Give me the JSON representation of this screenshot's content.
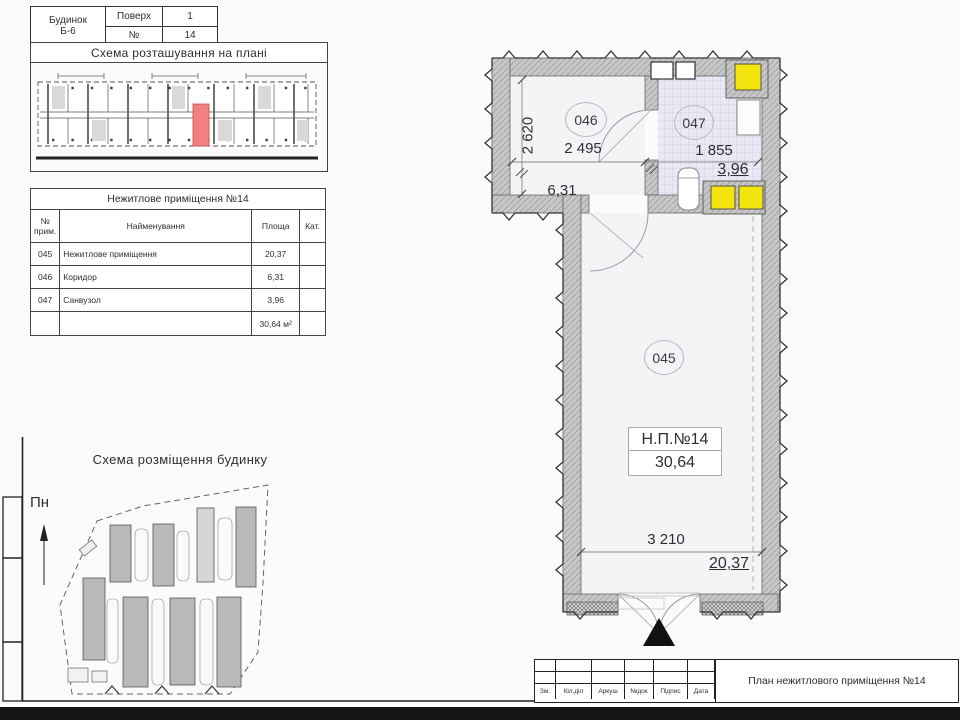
{
  "title_bar": {
    "building_label": "Будинок",
    "building_value": "Б-6",
    "floor_label": "Поверх",
    "floor_value": "1",
    "num_label": "№",
    "num_value": "14"
  },
  "location_scheme": {
    "title": "Схема розташування на плані"
  },
  "premises": {
    "title": "Нежитлове приміщення №14",
    "col_id": "№ прим.",
    "col_name": "Найменування",
    "col_area": "Площа",
    "col_cat": "Кат.",
    "rows": [
      {
        "id": "045",
        "name": "Нежитлове приміщення",
        "area": "20,37",
        "cat": ""
      },
      {
        "id": "046",
        "name": "Коридор",
        "area": "6,31",
        "cat": ""
      },
      {
        "id": "047",
        "name": "Санвузол",
        "area": "3,96",
        "cat": ""
      }
    ],
    "total": "30,64 м²"
  },
  "site_scheme": {
    "title": "Схема розміщення будинку",
    "north": "Пн"
  },
  "plan": {
    "room_045": {
      "number": "045",
      "name_label": "Н.П.№14",
      "area_label": "30,64",
      "width_dim": "3 210",
      "area": "20,37"
    },
    "room_046": {
      "number": "046",
      "height_dim": "2 620",
      "width_dim": "2 495",
      "area": "6,31"
    },
    "room_047": {
      "number": "047",
      "width_dim": "1 855",
      "area": "3,96"
    }
  },
  "stamp": {
    "cols": [
      "Зм.",
      "Кіл.діл",
      "Аркуш",
      "№док",
      "Підпис",
      "Дата"
    ],
    "doc_title": "План нежитлового приміщення №14"
  },
  "colors": {
    "highlight_red": "#f28080",
    "shaft_yellow": "#f2e40c",
    "wall_gray": "#c7c7c7",
    "bath_floor": "#e9e9f6"
  }
}
